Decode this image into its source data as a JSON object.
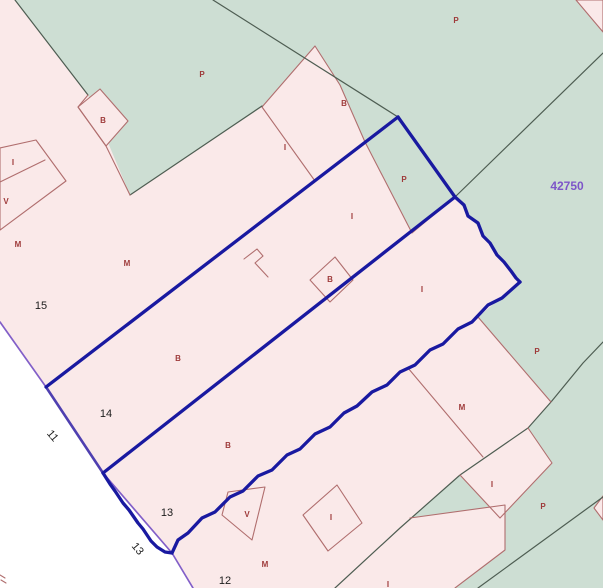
{
  "map": {
    "title": "cadastral-parcel-map",
    "canvas": {
      "width": 603,
      "height": 588,
      "background": "#ffffff"
    },
    "colors": {
      "pink": "#fae9e9",
      "green": "#cdded3",
      "road": "#ffffff",
      "red": "#b06e6e",
      "dark": "#4e5d52",
      "blue": "#1919a0",
      "violet": "#825fc8",
      "blueviolet": "#4f3fb0",
      "code_text": "#9e3a3a",
      "number_text": "#1c1c1c",
      "sheet_text": "#7d55c8"
    },
    "stroke_widths": {
      "red": 1.1,
      "dark": 1.2,
      "blue": 3.3,
      "violet": 1.7,
      "blueviolet": 2.6
    },
    "parcels": [
      {
        "name": "parcel-area-pink-main",
        "fill": "pink",
        "stroke": "none",
        "points": "0,0 603,0 603,588 193,588 172,553 103,473 46,387 0,322"
      },
      {
        "name": "road-area",
        "fill": "road",
        "stroke": "none",
        "points": "0,322 46,387 103,473 172,553 193,588 0,588"
      },
      {
        "name": "parcel-area-green-main",
        "fill": "green",
        "stroke": "none",
        "points": "15,0 576,0 603,32 603,588 335,588 400,528 460,475 500,518 552,463 528,428 551,402 478,317 520,282 455,197 398,117 365,142 340,85 315,46 262,107 130,195 88,95"
      },
      {
        "name": "parcel-green-inner-selected",
        "fill": "green",
        "stroke": "red",
        "points": "365,142 398,117 455,197 412,233"
      },
      {
        "name": "parcel-pink-b-north",
        "fill": "pink",
        "stroke": "red",
        "points": "262,107 315,46 340,85 365,142 315,181"
      },
      {
        "name": "parcel-pink-b-diamond-west",
        "fill": "pink",
        "stroke": "red",
        "points": "78,107 100,89 128,121 106,146"
      },
      {
        "name": "parcel-pink-topright-corner",
        "fill": "pink",
        "stroke": "red",
        "points": "576,0 603,0 603,32"
      },
      {
        "name": "parcel-pink-i-southeast",
        "fill": "pink",
        "stroke": "none",
        "points": "528,428 552,463 500,518 460,475"
      },
      {
        "name": "parcel-pink-south-wedge",
        "fill": "pink",
        "stroke": "none",
        "points": "410,518 505,505 505,550 455,588 335,588"
      },
      {
        "name": "parcel-pink-right-edge-sliver",
        "fill": "pink",
        "stroke": "red",
        "points": "603,496 594,508 603,520"
      }
    ],
    "boundaries": [
      {
        "name": "road-edge-violet",
        "color": "violet",
        "points": "0,322 46,387 103,473 172,553 193,588",
        "closed": false
      },
      {
        "name": "boundary-dark-topleft",
        "color": "dark",
        "points": "15,0 88,95",
        "closed": false
      },
      {
        "name": "boundary-dark-mid",
        "color": "dark",
        "points": "130,195 262,106",
        "closed": false
      },
      {
        "name": "boundary-dark-green-internal-1",
        "color": "dark",
        "points": "213,0 398,117",
        "closed": false
      },
      {
        "name": "boundary-dark-green-internal-2",
        "color": "dark",
        "points": "603,53 455,197",
        "closed": false
      },
      {
        "name": "boundary-dark-southeast",
        "color": "dark",
        "points": "603,342 583,363 551,402 528,428 460,475 400,528 335,588",
        "closed": false
      },
      {
        "name": "boundary-dark-bottomright",
        "color": "dark",
        "points": "603,497 478,588",
        "closed": false
      },
      {
        "name": "boundary-red-bdiamond-chain",
        "color": "red",
        "points": "88,95 78,107 106,146 130,195",
        "closed": false
      },
      {
        "name": "boundary-red-r1",
        "color": "red",
        "points": "478,317 551,402",
        "closed": false
      },
      {
        "name": "boundary-red-r2",
        "color": "red",
        "points": "408,368 483,457",
        "closed": false
      },
      {
        "name": "boundary-red-iparcel",
        "color": "red",
        "points": "528,428 552,463 500,518 460,475",
        "closed": false
      },
      {
        "name": "boundary-red-south-wedge",
        "color": "red",
        "points": "410,518 505,505 505,550 455,588",
        "closed": false
      },
      {
        "name": "parcel-red-v-diamond",
        "color": "red",
        "points": "228,492 265,487 252,540 222,515",
        "closed": true
      },
      {
        "name": "parcel-red-i-diamond",
        "color": "red",
        "points": "303,515 337,485 362,523 328,551",
        "closed": true
      },
      {
        "name": "parcel-red-b-small-diamond",
        "color": "red",
        "points": "335,257 310,280 330,302 353,280",
        "closed": true
      },
      {
        "name": "parcel-red-rect-northwest",
        "color": "red",
        "points": "0,148 36,140 66,181 0,230",
        "closed": true
      },
      {
        "name": "boundary-red-rect-inner",
        "color": "red",
        "points": "0,182 45,160",
        "closed": false
      },
      {
        "name": "boundary-red-step",
        "color": "red",
        "points": "244,259 257,249 263,256 255,263 268,277",
        "closed": false
      },
      {
        "name": "corner-mark-1",
        "color": "red",
        "points": "0,575 5,578",
        "closed": false
      },
      {
        "name": "corner-mark-2",
        "color": "red",
        "points": "1,580 6,583",
        "closed": false
      },
      {
        "name": "selection-road-side",
        "color": "blueviolet",
        "points": "46,387 103,473",
        "closed": false
      },
      {
        "name": "selection-edge-northwest",
        "color": "blue",
        "points": "46,387 398,117",
        "closed": false
      },
      {
        "name": "selection-edge-north",
        "color": "blue",
        "points": "398,117 455,197",
        "closed": false
      },
      {
        "name": "selection-divider",
        "color": "blue",
        "points": "103,473 455,197",
        "closed": false
      },
      {
        "name": "selection-edge-northeast-wavy",
        "color": "blue",
        "points": "455,197 464,205 468,216 478,223 483,236 490,243 497,255 504,262 511,271 516,278 520,282",
        "closed": false
      },
      {
        "name": "selection-edge-southeast-wavy",
        "color": "blue",
        "points": "520,282 502,298 488,305 472,322 458,329 443,344 430,350 415,365 400,372 387,385 372,392 357,406 344,413 330,427 315,434 300,449 287,455 272,470 258,476 243,491 230,497 215,512 202,518 188,533 178,540 172,553",
        "closed": false
      },
      {
        "name": "selection-edge-road-wavy",
        "color": "blue",
        "points": "103,473 110,484 115,491 123,503 129,510 138,523 143,529 151,541 157,547 165,552 172,553",
        "closed": false
      }
    ],
    "labels": {
      "items": [
        {
          "name": "land-code",
          "cls": "code",
          "text": "P",
          "x": 202,
          "y": 77
        },
        {
          "name": "land-code",
          "cls": "code",
          "text": "P",
          "x": 456,
          "y": 23
        },
        {
          "name": "land-code",
          "cls": "code",
          "text": "B",
          "x": 344,
          "y": 106
        },
        {
          "name": "land-code",
          "cls": "code",
          "text": "B",
          "x": 103,
          "y": 123
        },
        {
          "name": "land-code",
          "cls": "code",
          "text": "I",
          "x": 285,
          "y": 150
        },
        {
          "name": "land-code",
          "cls": "code",
          "text": "I",
          "x": 13,
          "y": 165
        },
        {
          "name": "land-code",
          "cls": "code",
          "text": "P",
          "x": 404,
          "y": 182
        },
        {
          "name": "land-code",
          "cls": "code",
          "text": "V",
          "x": 6,
          "y": 204
        },
        {
          "name": "land-code",
          "cls": "code",
          "text": "I",
          "x": 352,
          "y": 219
        },
        {
          "name": "land-code",
          "cls": "code",
          "text": "M",
          "x": 18,
          "y": 247
        },
        {
          "name": "land-code",
          "cls": "code",
          "text": "M",
          "x": 127,
          "y": 266
        },
        {
          "name": "land-code",
          "cls": "code",
          "text": "B",
          "x": 330,
          "y": 282
        },
        {
          "name": "land-code",
          "cls": "code",
          "text": "I",
          "x": 422,
          "y": 292
        },
        {
          "name": "land-code",
          "cls": "code",
          "text": "P",
          "x": 537,
          "y": 354
        },
        {
          "name": "land-code",
          "cls": "code",
          "text": "B",
          "x": 178,
          "y": 361
        },
        {
          "name": "land-code",
          "cls": "code",
          "text": "M",
          "x": 462,
          "y": 410
        },
        {
          "name": "land-code",
          "cls": "code",
          "text": "B",
          "x": 228,
          "y": 448
        },
        {
          "name": "land-code",
          "cls": "code",
          "text": "I",
          "x": 492,
          "y": 487
        },
        {
          "name": "land-code",
          "cls": "code",
          "text": "P",
          "x": 543,
          "y": 509
        },
        {
          "name": "land-code",
          "cls": "code",
          "text": "V",
          "x": 247,
          "y": 517
        },
        {
          "name": "land-code",
          "cls": "code",
          "text": "I",
          "x": 331,
          "y": 520
        },
        {
          "name": "land-code",
          "cls": "code",
          "text": "M",
          "x": 265,
          "y": 567
        },
        {
          "name": "land-code",
          "cls": "code",
          "text": "I",
          "x": 388,
          "y": 587
        },
        {
          "name": "parcel-number",
          "cls": "num",
          "text": "15",
          "x": 41,
          "y": 309
        },
        {
          "name": "parcel-number",
          "cls": "num",
          "text": "14",
          "x": 106,
          "y": 417
        },
        {
          "name": "parcel-number",
          "cls": "num",
          "text": "13",
          "x": 167,
          "y": 516
        },
        {
          "name": "parcel-number",
          "cls": "num",
          "text": "12",
          "x": 225,
          "y": 584
        },
        {
          "name": "road-number",
          "cls": "num",
          "text": "11",
          "x": 50,
          "y": 438,
          "rot": 50
        },
        {
          "name": "road-number",
          "cls": "num",
          "text": "13",
          "x": 135,
          "y": 551,
          "rot": 50
        },
        {
          "name": "sheet-number",
          "cls": "sheet",
          "text": "42750",
          "x": 567,
          "y": 190
        }
      ]
    },
    "text_styles": {
      "code": {
        "size": 8,
        "color_key": "code_text"
      },
      "num": {
        "size": 11,
        "color_key": "number_text"
      },
      "sheet": {
        "size": 12,
        "color_key": "sheet_text"
      }
    }
  }
}
